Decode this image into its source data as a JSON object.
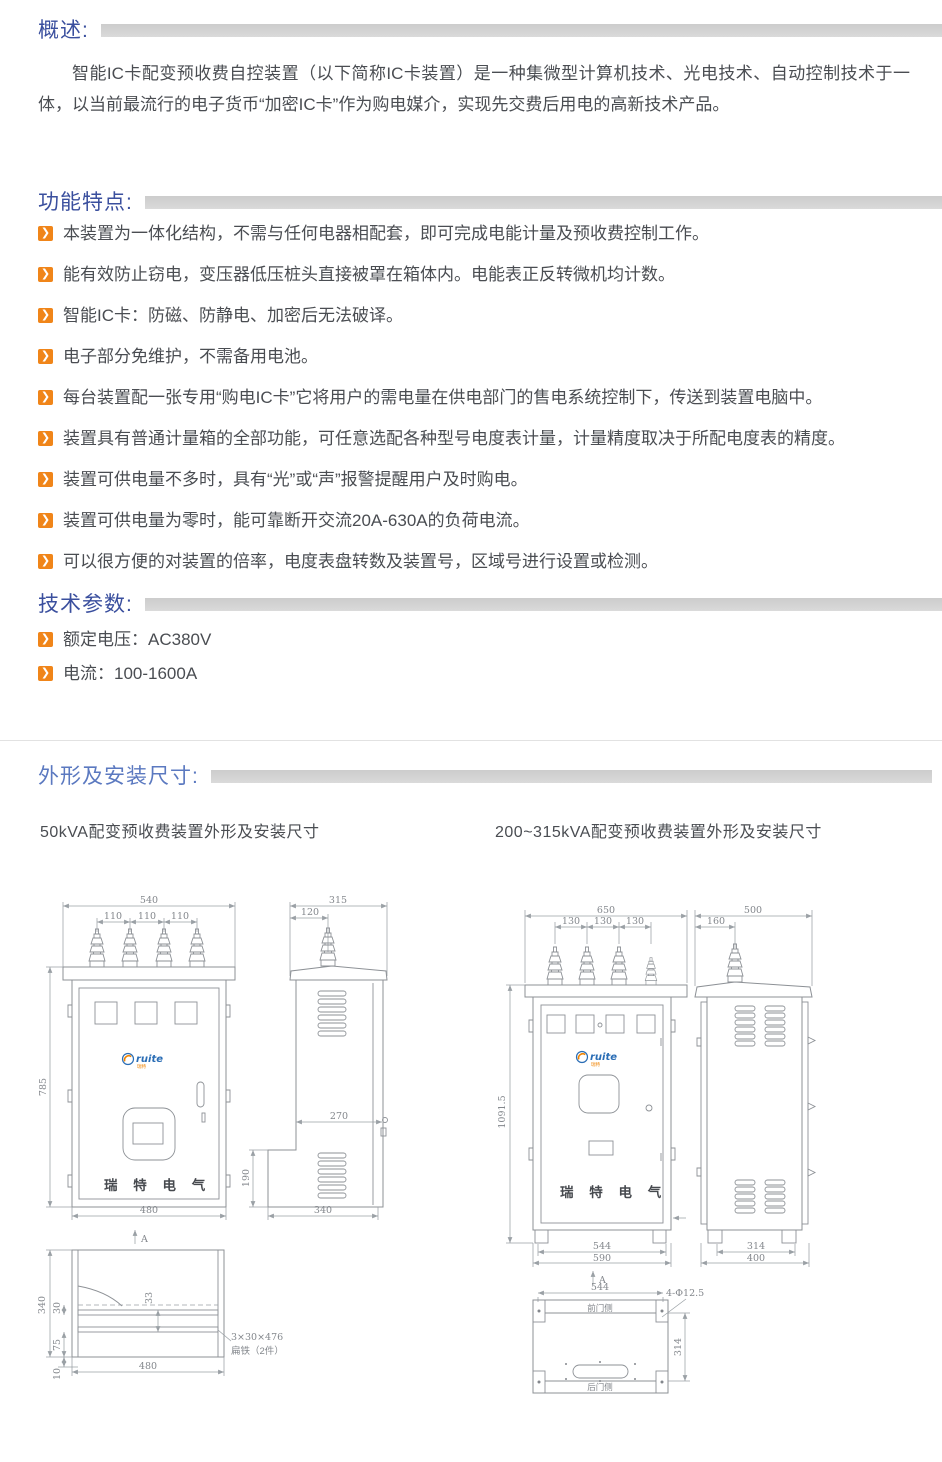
{
  "colors": {
    "heading_blue": "#3a4f9e",
    "heading_blue_light": "#5b79c0",
    "section_bar_gray": "#d4d4d4",
    "bullet_orange": "#f08519",
    "body_text": "#4a4d52",
    "drawing_line": "#8d9196",
    "logo_blue": "#2a6db5",
    "logo_orange": "#f08300"
  },
  "overview": {
    "heading": "概述:",
    "paragraph": "智能IC卡配变预收费自控装置（以下简称IC卡装置）是一种集微型计算机技术、光电技术、自动控制技术于一体，以当前最流行的电子货币“加密IC卡”作为购电媒介，实现先交费后用电的高新技术产品。"
  },
  "features": {
    "heading": "功能特点:",
    "items": [
      "本装置为一体化结构，不需与任何电器相配套，即可完成电能计量及预收费控制工作。",
      "能有效防止窃电，变压器低压桩头直接被罩在箱体内。电能表正反转微机均计数。",
      "智能IC卡：防磁、防静电、加密后无法破译。",
      "电子部分免维护，不需备用电池。",
      "每台装置配一张专用“购电IC卡”它将用户的需电量在供电部门的售电系统控制下，传送到装置电脑中。",
      "装置具有普通计量箱的全部功能，可任意选配各种型号电度表计量，计量精度取决于所配电度表的精度。",
      "装置可供电量不多时，具有“光”或“声”报警提醒用户及时购电。",
      "装置可供电量为零时，能可靠断开交流20A-630A的负荷电流。",
      "可以很方便的对装置的倍率，电度表盘转数及装置号，区域号进行设置或检测。"
    ]
  },
  "specs": {
    "heading": "技术参数:",
    "items": [
      "额定电压：AC380V",
      "电流：100-1600A"
    ]
  },
  "outline": {
    "heading": "外形及安装尺寸:",
    "left_subtitle": "50kVA配变预收费装置外形及安装尺寸",
    "right_subtitle": "200~315kVA配变预收费装置外形及安装尺寸",
    "brand_text": "瑞 特 电 气",
    "logo_text": "ruite",
    "logo_sub": "瑞特",
    "section_label": "A",
    "left": {
      "front": {
        "w": "540",
        "s1": "110",
        "s2": "110",
        "s3": "110",
        "h": "785",
        "base": "480"
      },
      "side": {
        "w": "315",
        "off": "120",
        "mid": "270",
        "low": "190",
        "base": "340"
      },
      "bottom": {
        "h": "340",
        "d30": "30",
        "d75": "75",
        "d10": "10",
        "d33": "33",
        "w": "480",
        "note1": "3×30×476",
        "note2": "扁铁（2件）"
      }
    },
    "right": {
      "front": {
        "w": "650",
        "s1": "130",
        "s2": "130",
        "s3": "130",
        "h": "1091.5",
        "base1": "544",
        "base2": "590"
      },
      "side": {
        "w": "500",
        "off": "160",
        "base1": "314",
        "base2": "400"
      },
      "bottom": {
        "w": "544",
        "h": "314",
        "holes": "4-Φ12.5",
        "front": "前门侧",
        "back": "后门侧"
      }
    }
  }
}
